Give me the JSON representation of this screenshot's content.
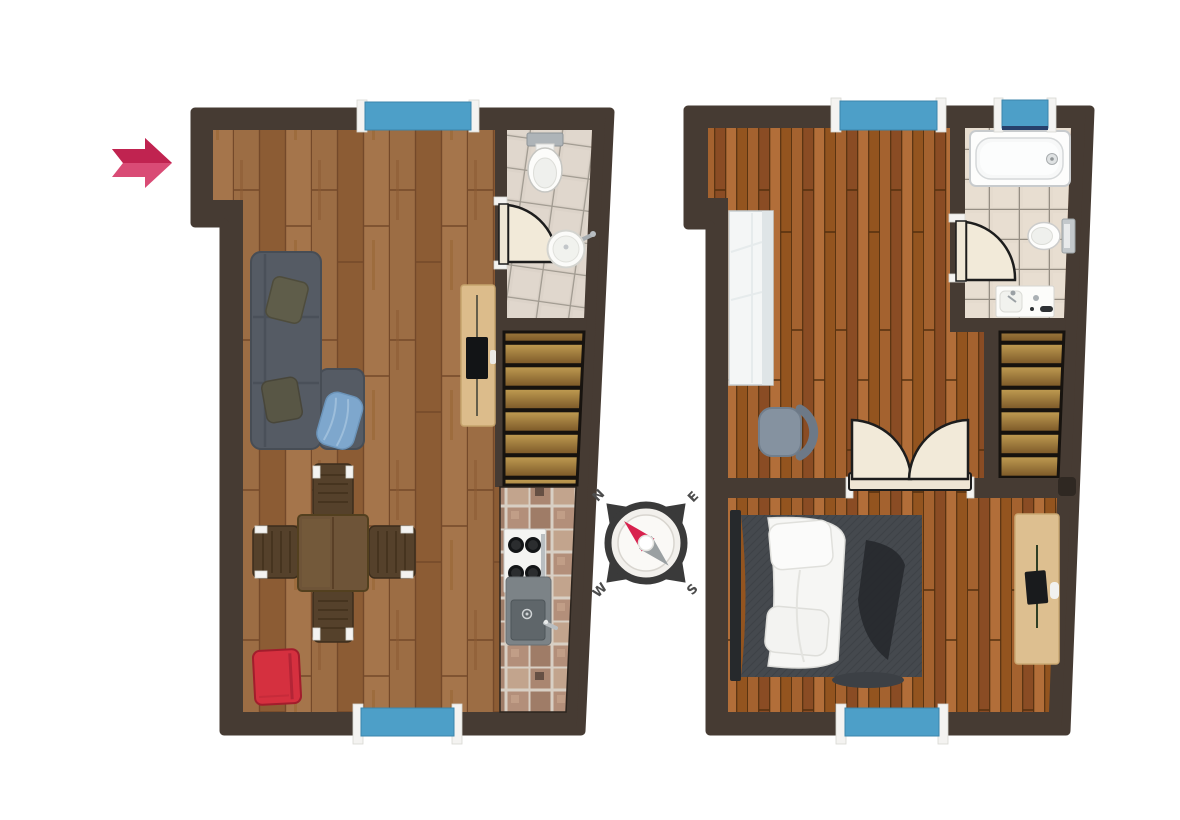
{
  "scene": {
    "type": "floor-plan",
    "floors_count": 2
  },
  "compass": {
    "north": "N",
    "east": "E",
    "south": "S",
    "west": "W"
  },
  "entrance": {
    "indicator": "arrow-right"
  },
  "colors": {
    "wall": "#463b33",
    "window": "#4d9fc8",
    "floor_left_base": "#996941",
    "floor_right_base": "#9a5c2e",
    "stair_tread": "#ab8440",
    "bath_tile": "#dcd3c9",
    "kitchen_tile": "#b28e79",
    "sofa": "#555b64",
    "armchair_red": "#d5303f",
    "table_wood": "#6e5438",
    "sideboard_wood": "#dcbc8b",
    "desk_wood": "#ddbf90",
    "bed_blanket": "#45494e",
    "bed_linen": "#f6f6f4",
    "wardrobe": "#f4f6f6",
    "office_chair": "#8592a0",
    "door_leaf": "#f2ead9",
    "arrow_dark": "#c02350",
    "arrow_light": "#d94b75",
    "compass_ring": "#3a3a3a",
    "compass_needle_red": "#d8224e",
    "compass_needle_gray": "#9aa0a2"
  },
  "floor_plans": [
    {
      "id": "left",
      "elements": [
        "living-area",
        "bathroom",
        "kitchen",
        "staircase",
        "sofa",
        "pillows",
        "blue-blanket",
        "tv-sideboard",
        "dining-table",
        "dining-chairs",
        "red-armchair",
        "stove",
        "kitchen-sink",
        "toilet",
        "wash-basin",
        "bathroom-door",
        "window-top",
        "window-bottom"
      ]
    },
    {
      "id": "right",
      "elements": [
        "bedroom",
        "study-area",
        "bathroom",
        "staircase",
        "bed",
        "wardrobe",
        "desk",
        "office-chair",
        "double-door",
        "bathtub",
        "toilet",
        "wash-basin",
        "bathroom-door",
        "window-top",
        "window-bathroom",
        "window-bottom"
      ]
    }
  ]
}
